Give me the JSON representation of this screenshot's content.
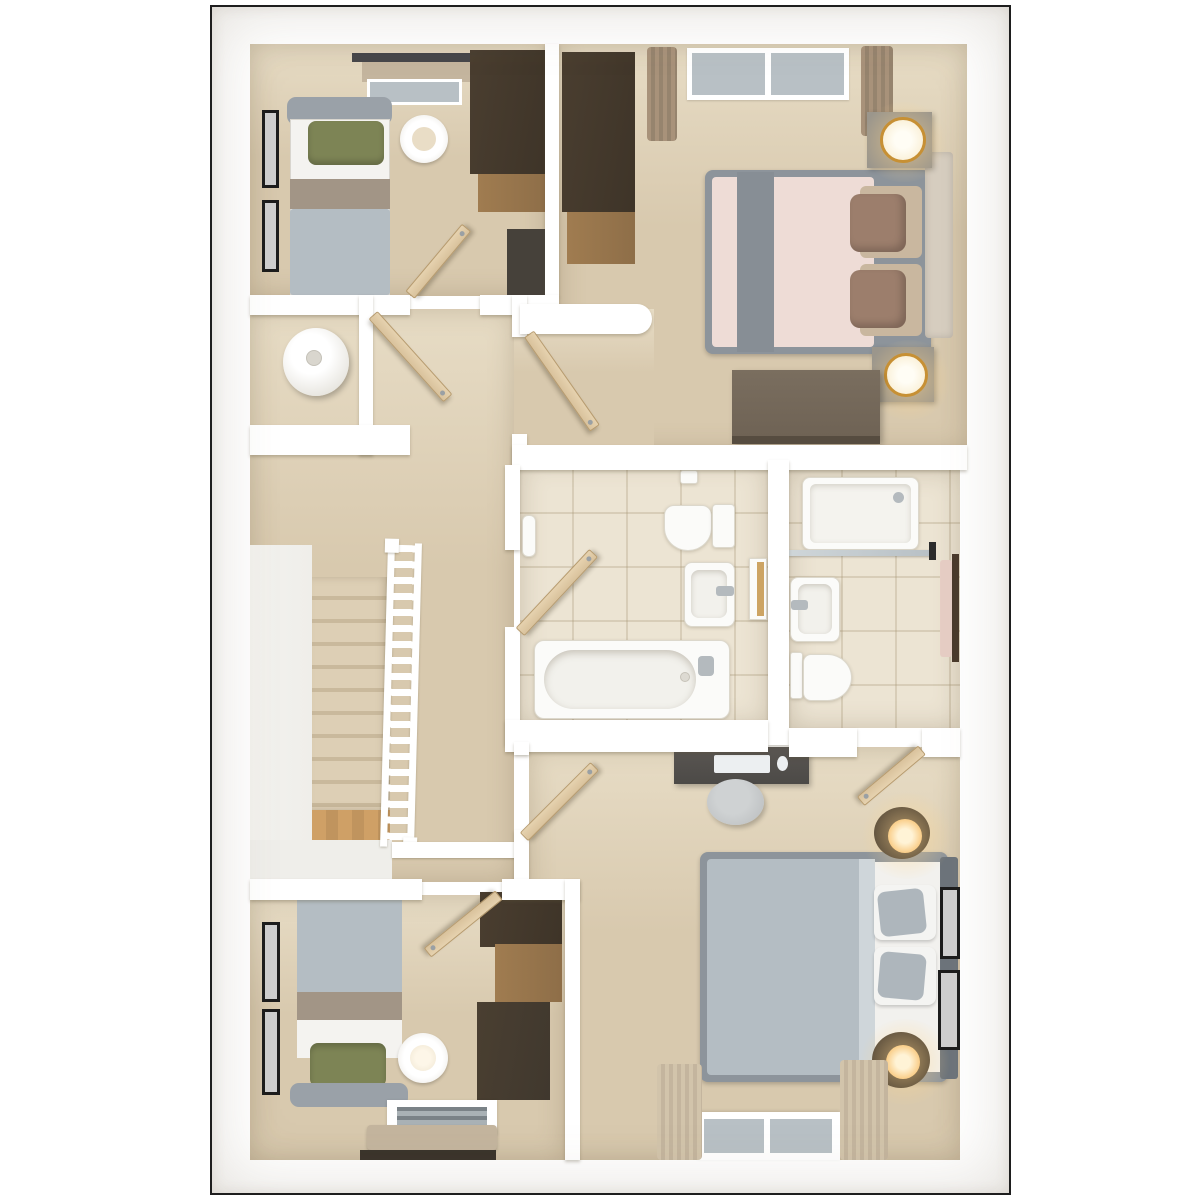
{
  "scene": {
    "type": "3d-floorplan-top-down-render",
    "style": "photoreal dollhouse view, white walls, beige carpet, cream tile",
    "rooms": [
      {
        "id": "bedroom-top-left",
        "floor": "carpet",
        "contents": [
          "single-bed-green-pillow",
          "gray-duvet",
          "taupe-runner",
          "wardrobe-dark",
          "chest-of-drawers",
          "round-side-table",
          "two-picture-frames",
          "window-with-blind"
        ]
      },
      {
        "id": "master-bedroom",
        "floor": "carpet",
        "contents": [
          "double-bed-blush-duvet",
          "gray-runner",
          "two-brown-pillows",
          "cream-headboard",
          "two-nightstands-with-gold-lamps",
          "wardrobe-dark",
          "blanket-bench",
          "window-with-curtains",
          "rounded-bulkhead-wall"
        ]
      },
      {
        "id": "airing-cupboard",
        "contents": [
          "hot-water-cylinder"
        ]
      },
      {
        "id": "landing",
        "floor": "carpet",
        "contents": [
          "staircase-down",
          "white-balustrade",
          "stair-void",
          "timber-lower-tread"
        ]
      },
      {
        "id": "bathroom",
        "floor": "tile",
        "contents": [
          "bathtub-with-chrome-tap",
          "toilet-with-cistern",
          "wall-hung-basin",
          "toilet-roll-holder",
          "towel-roll",
          "recessed-timber-shelf"
        ]
      },
      {
        "id": "ensuite-shower-room",
        "floor": "tile",
        "contents": [
          "shower-tray-with-glass-screen",
          "wall-hung-basin",
          "toilet",
          "pink-towel-on-dark-rail",
          "timber-trim"
        ]
      },
      {
        "id": "bedroom-bottom-right",
        "floor": "carpet",
        "contents": [
          "double-bed-gray-duvet",
          "dark-headboard",
          "two-round-nightstands-with-lit-lamps",
          "desk-with-keyboard-and-mouse",
          "gray-stool",
          "two-picture-frames",
          "window-with-curtains"
        ]
      },
      {
        "id": "bedroom-bottom-left",
        "floor": "carpet",
        "contents": [
          "single-bed-green-pillow",
          "gray-duvet",
          "taupe-runner",
          "two-tone-wardrobe",
          "round-side-table",
          "two-picture-frames",
          "window-with-roman-blind"
        ]
      }
    ],
    "doors_open": 7
  },
  "palette": {
    "page-bg": "#ffffff",
    "frame-border": "#1e1e1e",
    "wall": "#ffffff",
    "carpet": "#d8c9ae",
    "carpet-light": "#e7dcc5",
    "tile": "#ece4d3",
    "void": "#efeeea",
    "wood-floor": "#c0945e",
    "door-wood": "#d9c29c",
    "door-edge": "#b79b6e",
    "dark-wood": "#3e3428",
    "mid-wood": "#8e6e48",
    "gray-bed": "#b4bdc3",
    "blush": "#eedcd6",
    "runner-gray": "#878e95",
    "runner-taupe": "#a29586",
    "green": "#7d8455",
    "brown-pillow": "#9c7e6c",
    "tan": "#c9b79f",
    "headboard-gray": "#9aa1a8",
    "headboard-dark": "#6d747b",
    "cream": "#d6cdbf",
    "white-f": "#fbfbf9",
    "chrome": "#b4babe",
    "glass": "#b8c0c5",
    "curtain": "#96846e",
    "curtain-light": "#c4b59e",
    "glow": "#f5b14e",
    "gold": "#c79034",
    "black-frame": "#1d1d1d",
    "bench": "#6e6254",
    "stool": "#b8bbbd",
    "desk": "#4c4a47"
  }
}
